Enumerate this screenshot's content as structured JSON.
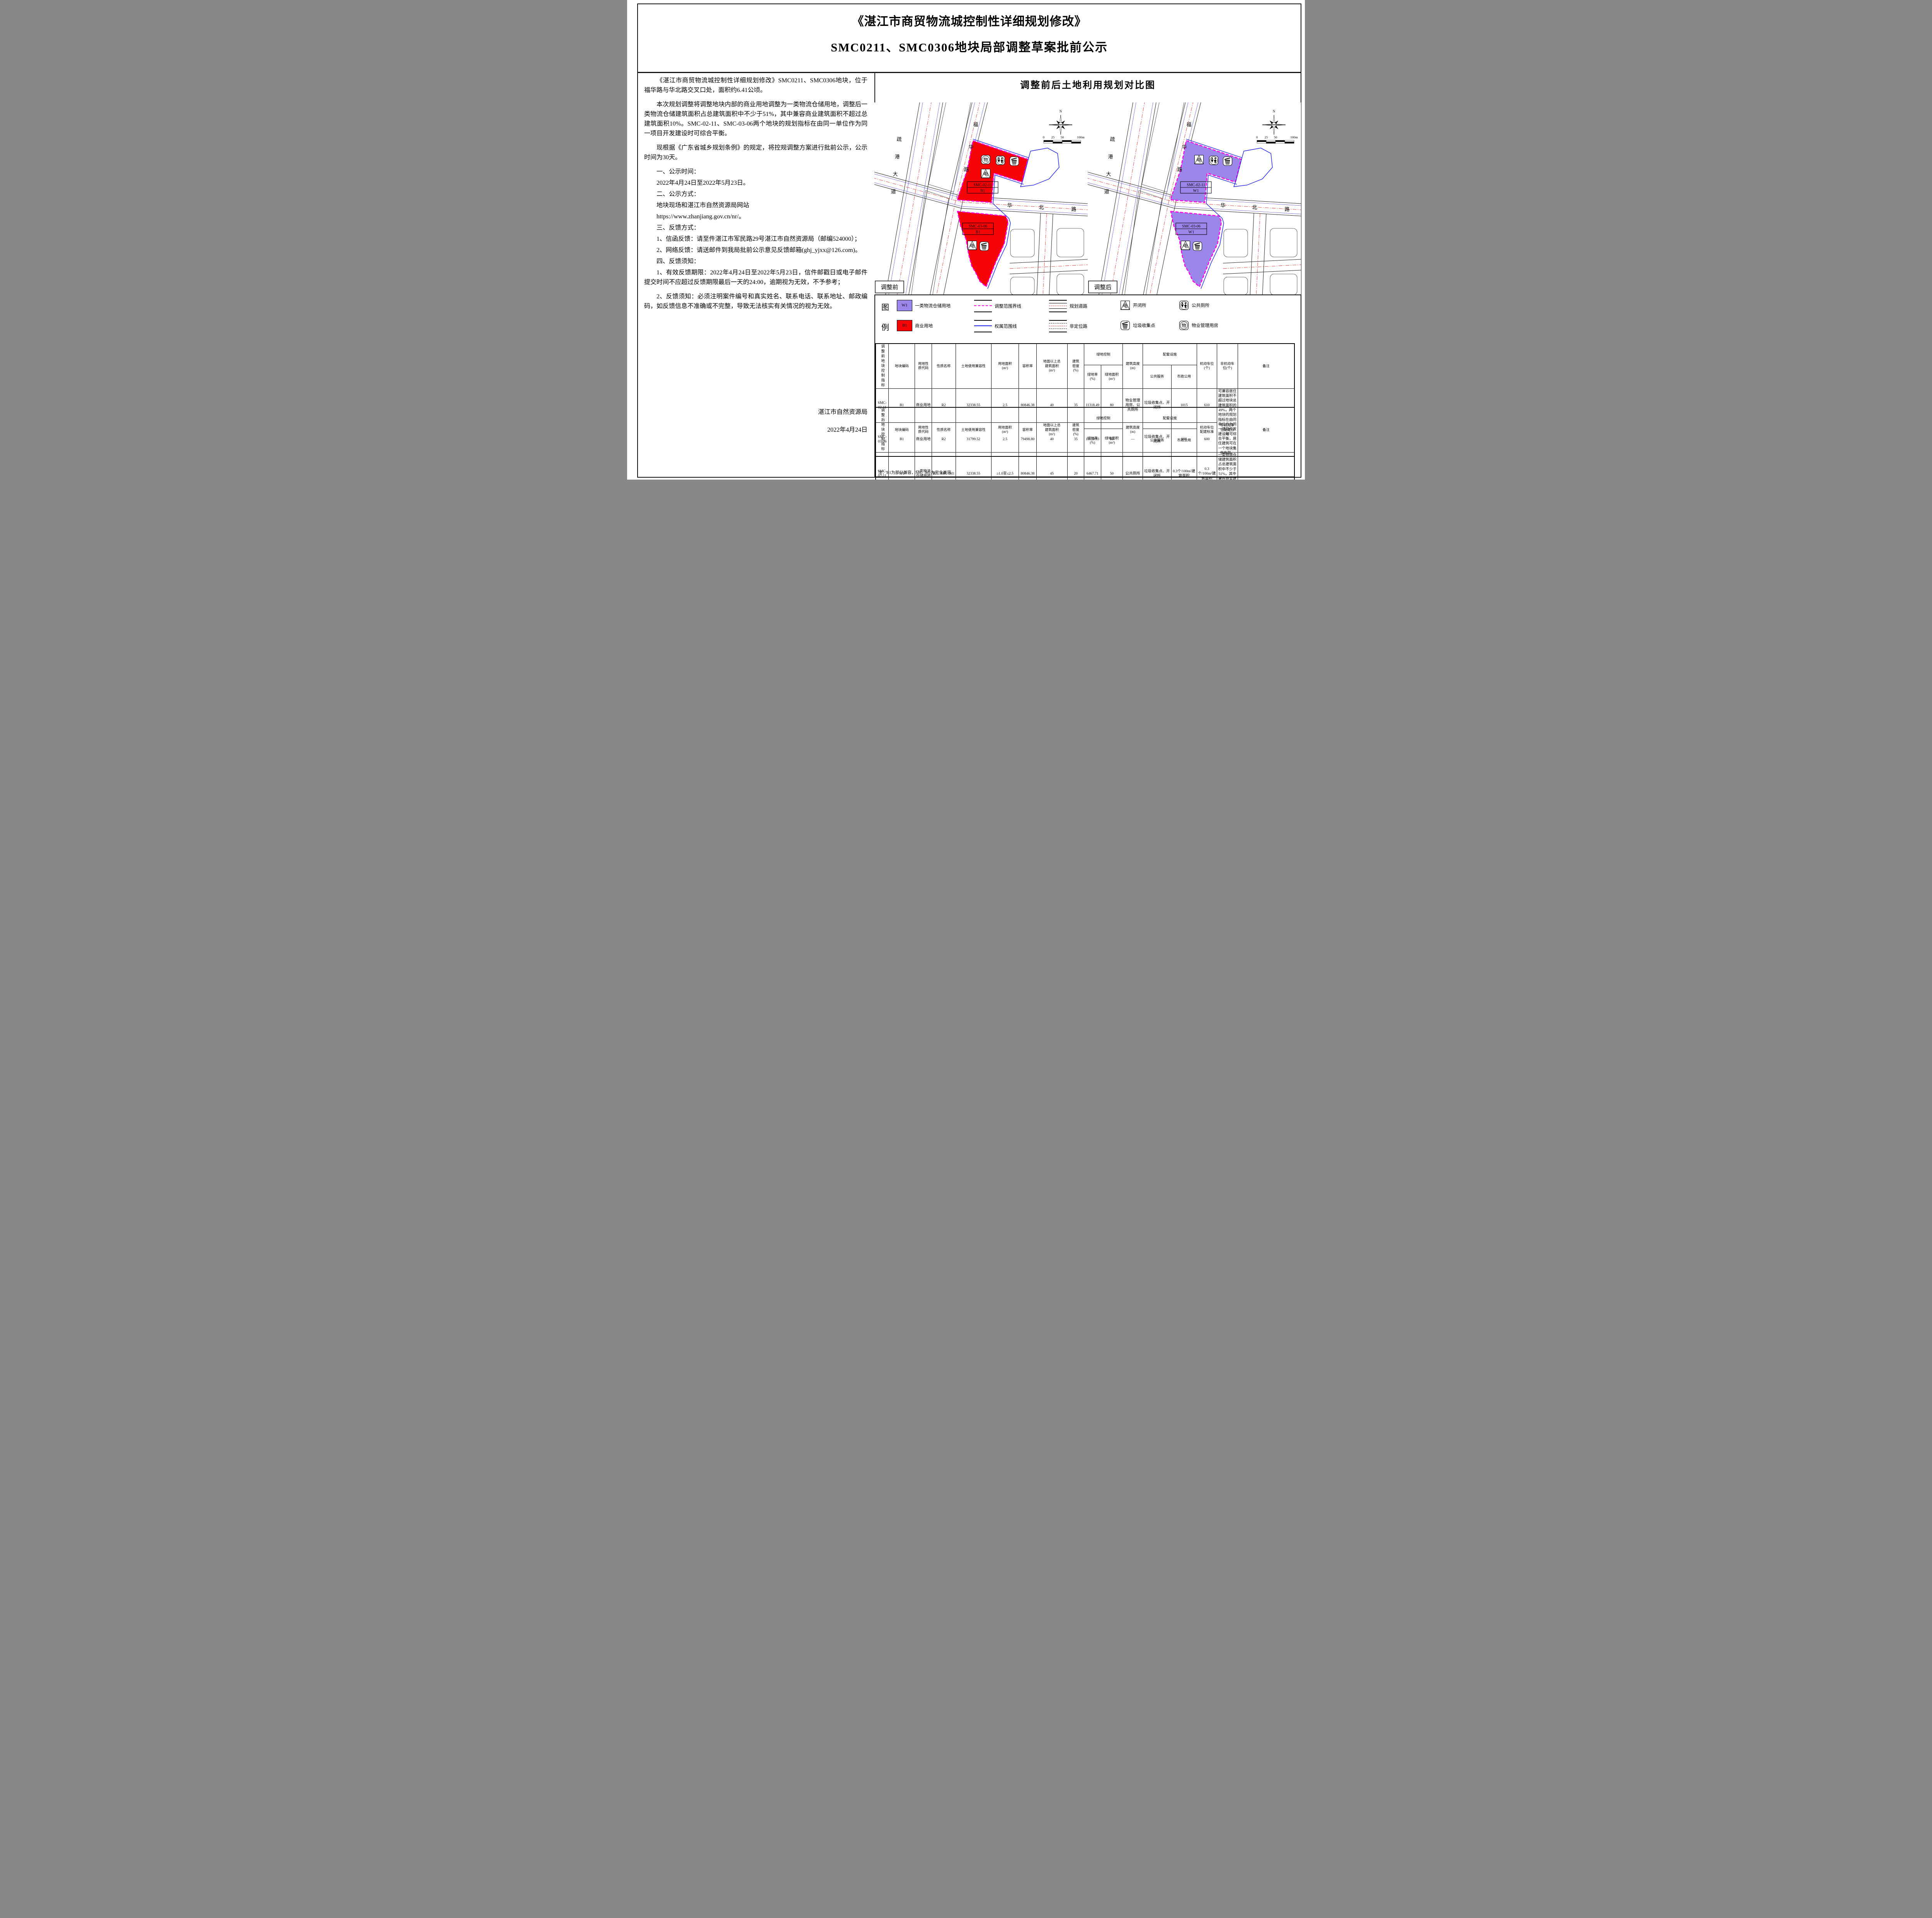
{
  "page_title": {
    "line1": "《湛江市商贸物流城控制性详细规划修改》",
    "line2": "SMC0211、SMC0306地块局部调整草案批前公示"
  },
  "notice": {
    "paragraphs": [
      "《湛江市商贸物流城控制性详细规划修改》SMC0211、SMC0306地块，位于福华路与华北路交叉口处，面积约6.41公顷。",
      "本次规划调整将调整地块内部的商业用地调整为一类物流仓储用地，调整后一类物流仓储建筑面积占总建筑面积中不少于51%，其中兼容商业建筑面积不超过总建筑面积10%。SMC-02-11、SMC-03-06两个地块的规划指标在由同一单位作为同一项目开发建设时可综合平衡。",
      "现根据《广东省城乡规划条例》的规定，将控规调整方案进行批前公示，公示时间为30天。",
      "一、公示时间：",
      "2022年4月24日至2022年5月23日。",
      "二、公示方式：",
      "地块现场和湛江市自然资源局网站",
      "https://www.zhanjiang.gov.cn/nr/。",
      "三、反馈方式：",
      "1、信函反馈：请至件湛江市军民路29号湛江市自然资源局（邮编524000）；",
      "2、网络反馈：请送邮件到我局批前公示意见反馈邮箱(ghj_yjxx@126.com)。",
      "四、反馈须知：",
      "1、有效反馈期限：2022年4月24日至2022年5月23日，信件邮戳日或电子邮件提交时间不应超过反馈期限最后一天的24:00，逾期视为无效，不予参考；",
      "2、反馈须知：必须注明案件编号和真实姓名、联系电话、联系地址、邮政编码，如反馈信息不准确或不完整，导致无法核实有关情况的视为无效。"
    ],
    "signature_org": "湛江市自然资源局",
    "signature_date": "2022年4月24日"
  },
  "comparison": {
    "title": "调整前后土地利用规划对比图",
    "north_label": "N",
    "scale_ticks": [
      "0",
      "25",
      "50",
      "100m"
    ],
    "roads": {
      "shugang": "疏港大道",
      "fuhua": "福华路",
      "huabei": "华北路"
    },
    "parcels": [
      {
        "code": "SMC-02-11"
      },
      {
        "code": "SMC-03-06"
      }
    ],
    "maps": {
      "before": {
        "label": "调整前",
        "use": "B1"
      },
      "after": {
        "label": "调整后",
        "use": "W1"
      }
    }
  },
  "icons": {
    "dian": {
      "glyph": "电",
      "label": "开闭所"
    },
    "wu": {
      "glyph": "物",
      "label": "物业管理用房"
    },
    "toilet": {
      "label": "公共厕所"
    },
    "trash": {
      "label": "垃圾收集点"
    }
  },
  "legend": {
    "label_top": "图",
    "label_bottom": "例",
    "items": [
      {
        "type": "swatch-w1",
        "code": "W1",
        "label": "一类物流仓储用地"
      },
      {
        "type": "line-magenta",
        "label": "调整范围界线"
      },
      {
        "type": "road-planned",
        "label": "规划道路"
      },
      {
        "type": "icon-dian",
        "label": "开闭所"
      },
      {
        "type": "icon-toilet",
        "label": "公共厕所"
      },
      {
        "type": "swatch-b1",
        "code": "B1",
        "label": "商业用地"
      },
      {
        "type": "line-blue",
        "label": "权属范围线"
      },
      {
        "type": "road-unlocated",
        "label": "非定位路"
      },
      {
        "type": "icon-trash",
        "label": "垃圾收集点"
      },
      {
        "type": "icon-wu",
        "label": "物业管理用房"
      }
    ]
  },
  "colors": {
    "b1": "#f50505",
    "w1": "#9b87ea",
    "adjust_boundary": "#ff00e6",
    "property_line": "#1a1aee",
    "road_centerline": "#e03a3a"
  },
  "tables": {
    "headers": {
      "plot_code": "地块编码",
      "use_code": "用地性\n质代码",
      "use_name": "性质名称",
      "compat": "土地使用兼容性",
      "land_area": "用地面积\n(m²)",
      "far": "容积率",
      "gfa": "地面以上总\n建筑面积\n(m²)",
      "density": "建筑\n密度\n(%)",
      "green_control": "绿地控制",
      "green_rate": "绿地率\n(%)",
      "green_area": "绿地面积\n(m²)",
      "height": "建筑高度\n(m)",
      "facilities": "配套设施",
      "public_service": "公共服务",
      "municipal": "市政公用",
      "remark": "备注",
      "parking_before": "机动车位\n(个)",
      "nonmotor_before": "非机动车\n位(个)",
      "parking_after": "机动车位\n配建标准",
      "nonmotor_after": "非机动车\n位配建标\n准"
    },
    "before": {
      "group_label": "调整前地块控制指标",
      "rows": [
        [
          "SMC-02-11",
          "B1",
          "商业用地",
          "R2",
          "32338.55",
          "2.5",
          "80846.38",
          "40",
          "35",
          "11318.49",
          "80",
          "物业管理用房、公共厕所",
          "垃圾收集点、开闭所",
          "1015",
          "610"
        ],
        [
          "SMC-03-06",
          "B1",
          "商业用地",
          "R2",
          "31799.52",
          "2.5",
          "79498.80",
          "40",
          "35",
          "11129.83",
          "80",
          "—",
          "垃圾收集点、开闭所",
          "998",
          "600"
        ]
      ],
      "remark": "可兼容居住建筑面积不超过地块总建筑面积的49%，两个地块的规划指标在由同单位作为同一项目开发建设时可综合平衡，居住建筑可在一个地块集中布局。"
    },
    "after": {
      "group_label": "调整后地块控制指标",
      "rows": [
        [
          "SMC-02-11",
          "W1",
          "一类物流仓储用地",
          "B1、M0、M1",
          "32338.55",
          "≥1.0至≤2.5",
          "80846.38",
          "45",
          "20",
          "6467.71",
          "50",
          "公共厕所",
          "垃圾收集点、开闭所",
          "0.3个/100m²建筑面积",
          "0.3个/100m²建筑面积"
        ],
        [
          "SMC-03-06",
          "W1",
          "一类物流仓储用地",
          "B1、M0、M1",
          "31799.52",
          "≥1.0至≤2.5",
          "79498.80",
          "45",
          "20",
          "6359.90",
          "50",
          "—",
          "垃圾收集点、开闭所",
          "0.3个/100m²建筑面积",
          "0.3个/100m²建筑面积"
        ]
      ],
      "remark": "一类物流仓储建筑面积占总建筑面积中不少于51%，其中兼容商业建筑面积不超过总建筑面积10%。SMC-02-11、SMC-03-06两个地块的规划指标在由同一单位作为同一项目开发建设时可综合平衡。"
    },
    "note": "注：B1为部分兼容，M0、M1为完全兼容"
  }
}
